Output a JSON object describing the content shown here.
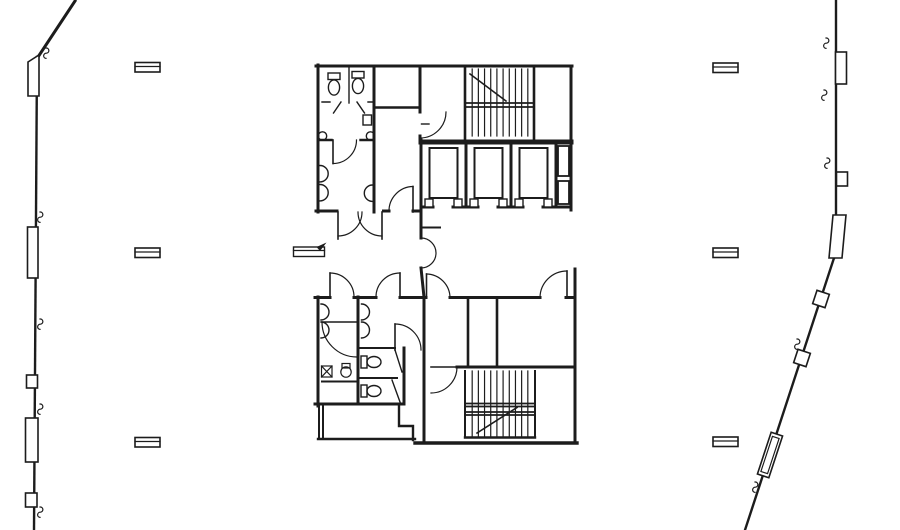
{
  "meta": {
    "document_type": "architectural-floor-plan",
    "description": "Black line-work floor plan of a high-rise typical floor: central service core with two stairs, three elevators, restrooms, and slanted curtain-wall exterior on left and right"
  },
  "drawing": {
    "colors": {
      "ink": "#1c1c1c",
      "paper": "#ffffff"
    },
    "column_markers": [
      {
        "cx": 147.5,
        "cy": 67.5
      },
      {
        "cx": 147.5,
        "cy": 253
      },
      {
        "cx": 147.5,
        "cy": 442.5
      },
      {
        "cx": 725.5,
        "cy": 68
      },
      {
        "cx": 725.5,
        "cy": 253
      },
      {
        "cx": 725.5,
        "cy": 442
      }
    ],
    "break_marks": [
      {
        "x": 46,
        "y": 48
      },
      {
        "x": 40,
        "y": 212
      },
      {
        "x": 40,
        "y": 319
      },
      {
        "x": 40,
        "y": 404
      },
      {
        "x": 40,
        "y": 507
      },
      {
        "x": 826,
        "y": 38
      },
      {
        "x": 824,
        "y": 90
      },
      {
        "x": 827,
        "y": 158
      },
      {
        "x": 797,
        "y": 339
      },
      {
        "x": 755,
        "y": 482
      }
    ],
    "direction_arrow": {
      "x": 293.5,
      "y": 243
    },
    "stairs": [
      {
        "name": "stair-north",
        "left": 466,
        "right": 534,
        "top": 69,
        "bottom": 136,
        "treads": 10,
        "landing_ys": [
          103,
          107
        ],
        "diagonal": [
          470,
          74,
          506,
          101
        ]
      },
      {
        "name": "stair-south",
        "left": 466,
        "right": 534,
        "top": 371,
        "bottom": 436,
        "treads": 10,
        "landing_ys": [
          403.5,
          406.5,
          412,
          415
        ],
        "diagonal": [
          477,
          433,
          517,
          407.5
        ]
      }
    ],
    "elevators": {
      "shafts": [
        {
          "x": 421,
          "w": 45
        },
        {
          "x": 466,
          "w": 45
        },
        {
          "x": 511,
          "w": 45
        }
      ],
      "car": {
        "inset_x": 8.5,
        "top": 148,
        "w": 28,
        "h": 50
      },
      "tab": {
        "y": 199,
        "w": 8,
        "h": 8
      }
    }
  }
}
